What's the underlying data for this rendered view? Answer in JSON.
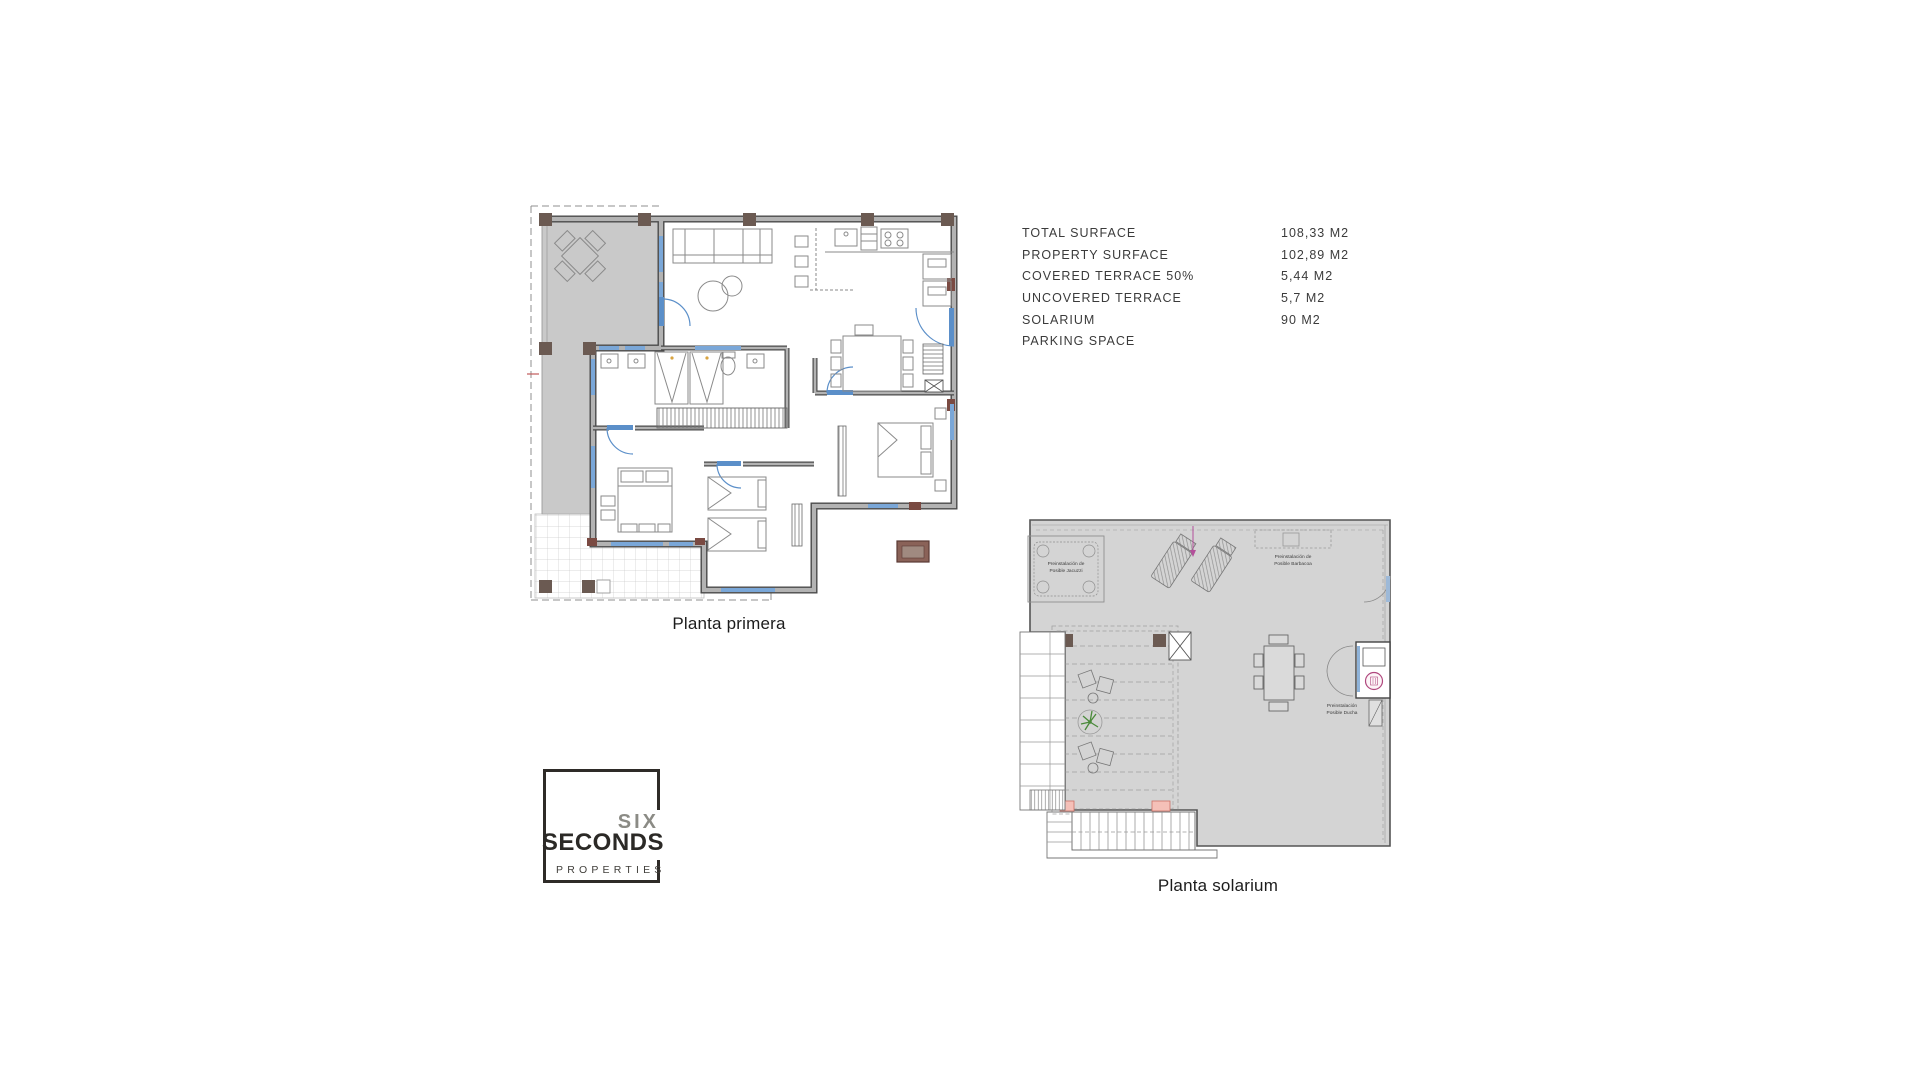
{
  "plan_primera": {
    "title": "Planta primera"
  },
  "plan_solarium": {
    "title": "Planta solarium",
    "annotations": {
      "jacuzzi": [
        "Preinstalación de",
        "Posible Jacuzzi"
      ],
      "barbacoa": [
        "Preinstalación de",
        "Posible Barbacoa"
      ],
      "ducha": [
        "Preinstalación",
        "Posible Ducha"
      ]
    }
  },
  "surface_table": {
    "rows": [
      {
        "label": "TOTAL SURFACE",
        "value": "108,33 M2"
      },
      {
        "label": "PROPERTY SURFACE",
        "value": "102,89 M2"
      },
      {
        "label": "COVERED TERRACE 50%",
        "value": "5,44 M2"
      },
      {
        "label": "UNCOVERED TERRACE",
        "value": "5,7 M2"
      },
      {
        "label": "SOLARIUM",
        "value": "90 M2"
      },
      {
        "label": "PARKING SPACE",
        "value": ""
      }
    ]
  },
  "logo": {
    "top": "SIX",
    "middle": "SECONDS",
    "bottom": "PROPERTIES"
  },
  "colors": {
    "wall_core": "#b3b3b3",
    "wall_edge": "#4a4a4a",
    "terrace_gray": "#c9c9c9",
    "deck_gray": "#d4d4d4",
    "window_blue": "#7aa7d8",
    "door_blue": "#5b8fc9",
    "pillar_brown": "#6b5a52",
    "accent_maroon": "#7a4a42",
    "salmon_pillar": "#f5c0b8",
    "plant_green": "#4a8a3a",
    "shower_magenta": "#b0487e",
    "text_dark": "#3b3b3b"
  }
}
